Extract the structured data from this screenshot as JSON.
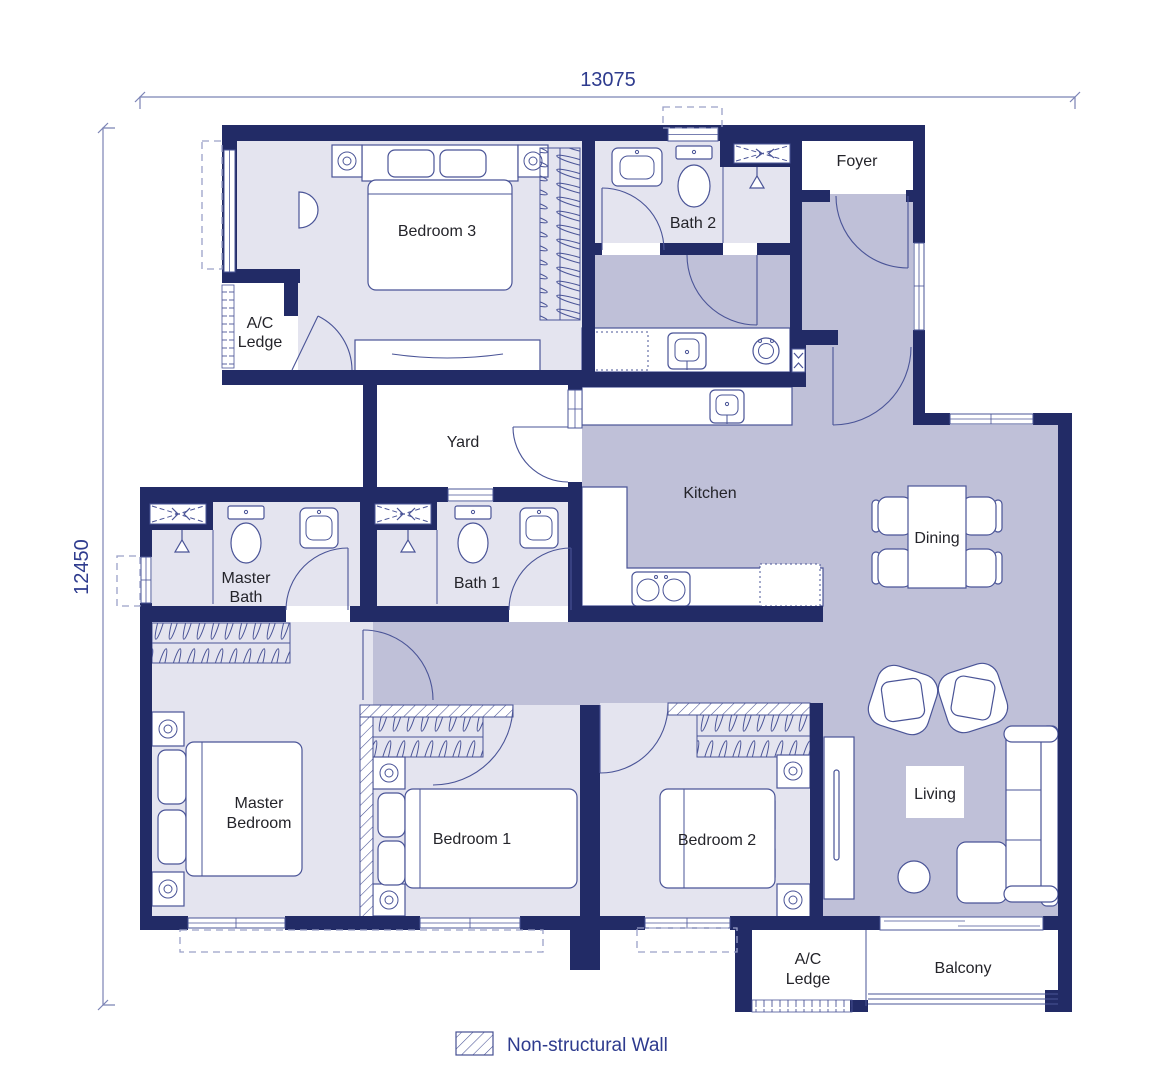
{
  "title": "Apartment floor plan",
  "dimensions": {
    "top": "13075",
    "left": "12450"
  },
  "rooms": {
    "bedroom3": "Bedroom 3",
    "bath2": "Bath 2",
    "foyer": "Foyer",
    "ac_ledge_top_l1": "A/C",
    "ac_ledge_top_l2": "Ledge",
    "yard": "Yard",
    "kitchen": "Kitchen",
    "dining": "Dining",
    "master_bath_l1": "Master",
    "master_bath_l2": "Bath",
    "bath1": "Bath 1",
    "master_bedroom_l1": "Master",
    "master_bedroom_l2": "Bedroom",
    "bedroom1": "Bedroom 1",
    "bedroom2": "Bedroom 2",
    "living": "Living",
    "ac_ledge_bottom_l1": "A/C",
    "ac_ledge_bottom_l2": "Ledge",
    "balcony": "Balcony"
  },
  "legend": {
    "non_structural_wall": "Non-structural Wall"
  },
  "colors": {
    "wall": "#222b66",
    "room_light": "#e4e4ef",
    "room_medium": "#bfc0d8",
    "line": "#4a5497",
    "dim_text": "#2e3b8e",
    "label_text": "#24242a",
    "dashed": "#9aa0c8",
    "hatch": "#454f93"
  }
}
